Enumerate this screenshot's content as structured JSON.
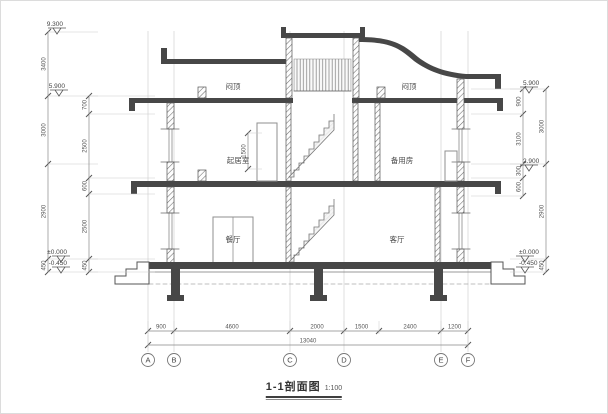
{
  "title": {
    "name": "1-1剖面图",
    "scale": "1:100"
  },
  "rooms": [
    {
      "label": "闷顶",
      "x": 232,
      "y": 88
    },
    {
      "label": "闷顶",
      "x": 408,
      "y": 88
    },
    {
      "label": "起居室",
      "x": 237,
      "y": 162
    },
    {
      "label": "备用房",
      "x": 401,
      "y": 162
    },
    {
      "label": "餐厅",
      "x": 232,
      "y": 241
    },
    {
      "label": "客厅",
      "x": 396,
      "y": 241
    }
  ],
  "elevations": [
    {
      "value": "9.300",
      "x": 56,
      "y": 33,
      "side": "left"
    },
    {
      "value": "5.900",
      "x": 58,
      "y": 95,
      "side": "left"
    },
    {
      "value": "±0.000",
      "x": 60,
      "y": 261,
      "side": "left"
    },
    {
      "value": "-0.450",
      "x": 60,
      "y": 272,
      "side": "left"
    },
    {
      "value": "5.900",
      "x": 528,
      "y": 92,
      "side": "right"
    },
    {
      "value": "2.900",
      "x": 528,
      "y": 170,
      "side": "right"
    },
    {
      "value": "±0.000",
      "x": 524,
      "y": 261,
      "side": "right"
    },
    {
      "value": "-0.450",
      "x": 524,
      "y": 272,
      "side": "right"
    }
  ],
  "vdims": [
    {
      "x": 47,
      "dir": 1,
      "ext": 50,
      "ticks": [
        31,
        95,
        163,
        258,
        271
      ],
      "labels": [
        "3400",
        "3000",
        "2900",
        "450"
      ]
    },
    {
      "x": 88,
      "dir": 1,
      "ext": 66,
      "ticks": [
        95,
        113,
        177,
        193,
        258,
        271
      ],
      "labels": [
        "700",
        "2500",
        "600",
        "2500",
        "450"
      ]
    },
    {
      "x": 247,
      "dir": 1,
      "ext": 14,
      "ticks": [
        132,
        168
      ],
      "labels": [
        "1500"
      ]
    },
    {
      "x": 522,
      "dir": -1,
      "ext": 52,
      "ticks": [
        88,
        113,
        163,
        177,
        195
      ],
      "labels": [
        "900",
        "3100",
        "300",
        "600"
      ]
    },
    {
      "x": 545,
      "dir": -1,
      "ext": 36,
      "ticks": [
        88,
        163,
        258,
        271
      ],
      "labels": [
        "3000",
        "2900",
        "450"
      ]
    }
  ],
  "hdims": [
    {
      "y": 330,
      "ticks": [
        147,
        173,
        289,
        343,
        378,
        440,
        467
      ],
      "labels": [
        "900",
        "4600",
        "2000",
        "1500",
        "2400",
        "1200"
      ]
    },
    {
      "y": 344,
      "ticks": [
        147,
        467
      ],
      "labels": [
        "13040"
      ]
    }
  ],
  "axes": {
    "y": 359,
    "items": [
      {
        "label": "A",
        "x": 147
      },
      {
        "label": "B",
        "x": 173
      },
      {
        "label": "C",
        "x": 289
      },
      {
        "label": "D",
        "x": 343
      },
      {
        "label": "E",
        "x": 440
      },
      {
        "label": "F",
        "x": 467
      }
    ]
  }
}
